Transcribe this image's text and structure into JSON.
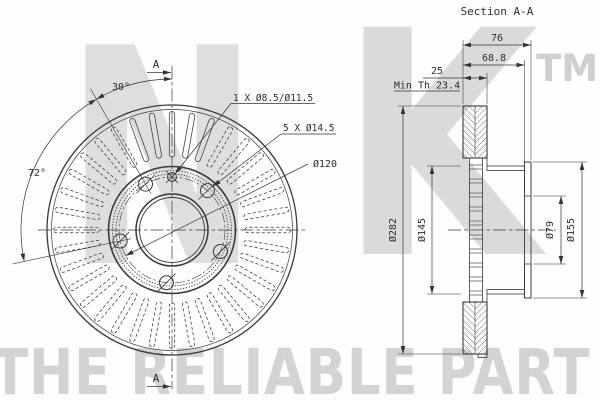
{
  "watermark": {
    "letter_n": "N",
    "letter_k": "K",
    "tm": "TM",
    "tagline": "THE RELIABLE PART"
  },
  "front_view": {
    "cut_label": "A",
    "angle_small": "30°",
    "angle_large": "72°",
    "pin_hole_label": "1 X Ø8.5/Ø11.5",
    "bolt_hole_label": "5 X Ø14.5",
    "bolt_circle_label": "Ø120"
  },
  "section_view": {
    "title": "Section A-A",
    "total_width": "76",
    "hat_depth": "68.8",
    "disc_thickness": "25",
    "min_thickness": "Min Th 23.4",
    "outer_diameter": "Ø282",
    "hat_diameter": "Ø145",
    "bore_diameter": "Ø79",
    "flange_diameter": "Ø155"
  },
  "geometry": {
    "front": {
      "cx": 172,
      "cy": 230,
      "circles": [
        {
          "name": "disc-outer-edge",
          "r": 125,
          "sw": 1.3
        },
        {
          "name": "disc-outer-chamfer",
          "r": 120.5,
          "sw": 0.7
        },
        {
          "name": "hat-edge-circle",
          "r": 63.5,
          "sw": 1.6
        },
        {
          "name": "serration-outer",
          "r": 59.5,
          "sw": 0.9,
          "dash": "1.3 1.6"
        },
        {
          "name": "serration-inner",
          "r": 56,
          "sw": 0.9,
          "dash": "1.3 1.6"
        },
        {
          "name": "bolt-circle",
          "r": 53,
          "sw": 0.6,
          "dash": "10 2.5 2.5 2.5"
        },
        {
          "name": "bore-chamfer",
          "r": 36,
          "sw": 1.5
        },
        {
          "name": "bore-edge",
          "r": 32.5,
          "sw": 0.9
        }
      ],
      "slots": {
        "count": 36,
        "step_deg": 10,
        "inner_r": 73,
        "outer_r": 118.5,
        "width": 5.4,
        "solid_angles": [
          250,
          260,
          270,
          280,
          290
        ],
        "dash": "3.2 2.2"
      },
      "bolt_holes": {
        "angles_deg": [
          240,
          312,
          24,
          96,
          168
        ],
        "circle_r": 53,
        "hole_r": 7
      },
      "pin_hole": {
        "angle_deg": 270,
        "circle_r": 53,
        "hole_r": 4.5
      }
    },
    "section_rungs": {
      "x1": 469.5,
      "x2": 482.5,
      "y_start": 165,
      "step": 14,
      "pair_gap": 4,
      "count": 10
    }
  }
}
